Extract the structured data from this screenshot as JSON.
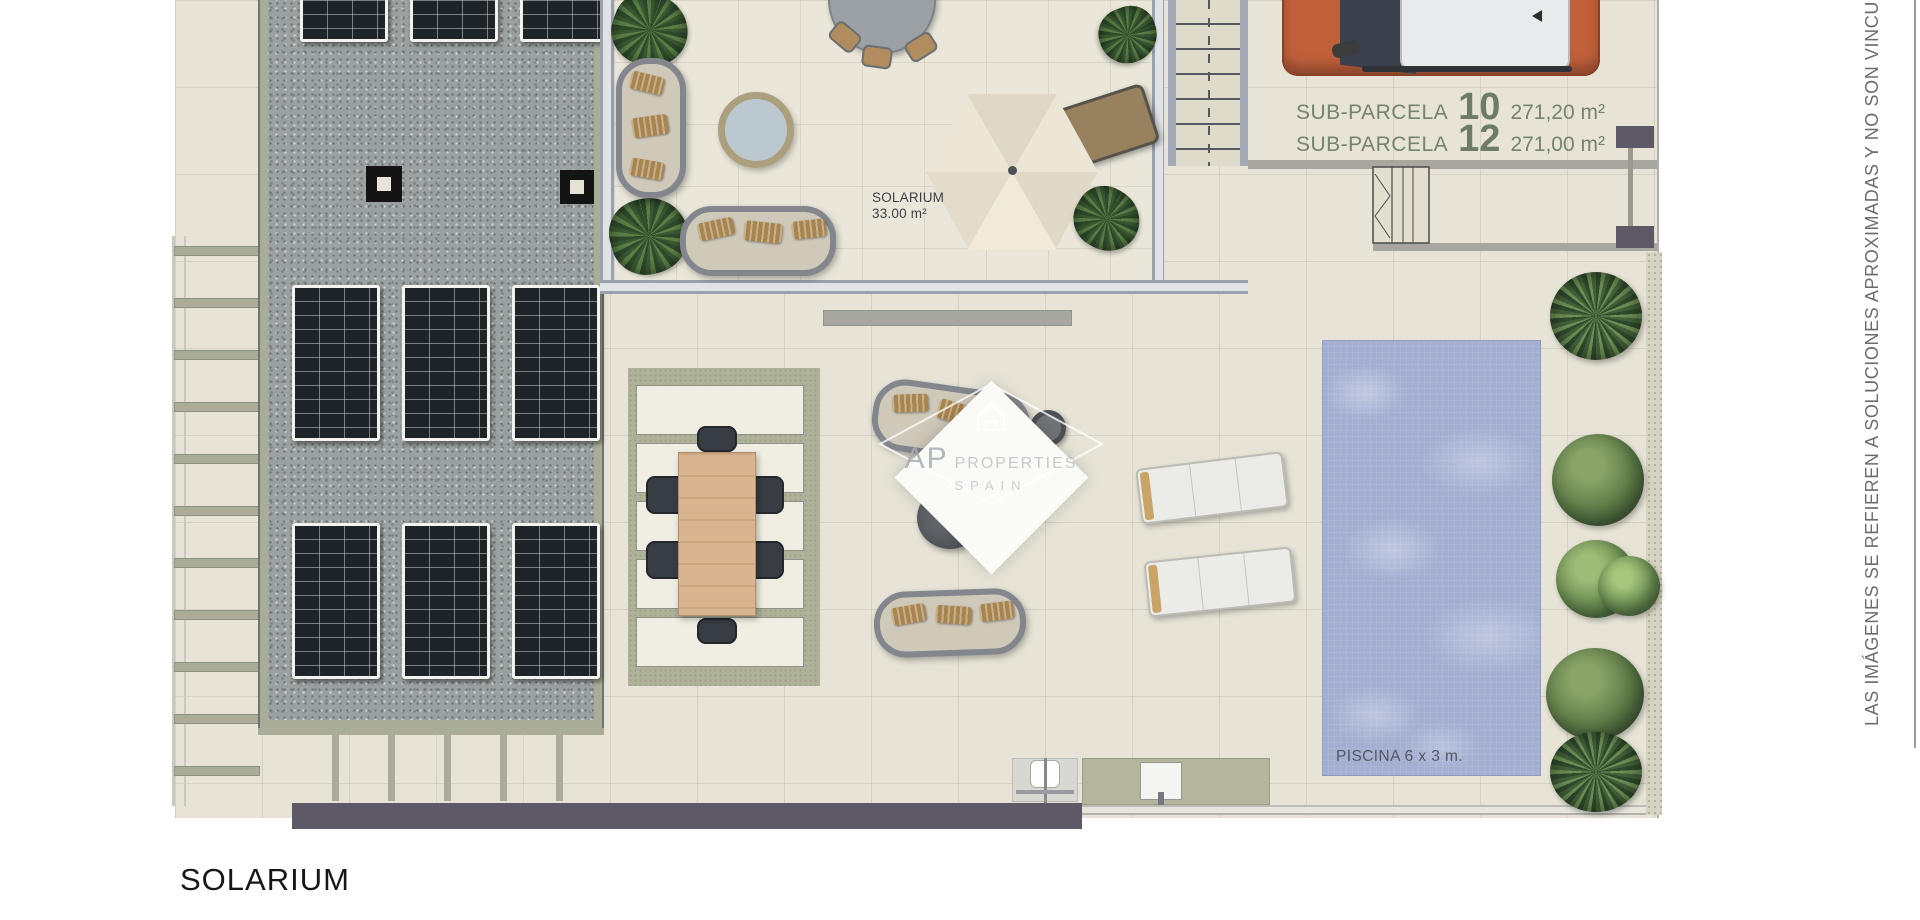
{
  "plan": {
    "title": "SOLARIUM",
    "disclaimer": "LAS IMÁGENES SE REFIEREN A SOLUCIONES APROXIMADAS Y NO SON VINCU",
    "watermark": {
      "brand_initials": "AP",
      "brand_name": "PROPERTIES",
      "brand_region": "SPAIN"
    },
    "labels": {
      "sub_parcelas": [
        {
          "name": "SUB-PARCELA",
          "number": "10",
          "area": "271,20 m²"
        },
        {
          "name": "SUB-PARCELA",
          "number": "12",
          "area": "271,00 m²"
        }
      ],
      "solarium_zone": {
        "name": "SOLARIUM",
        "area": "33.00 m²"
      },
      "pool": "PISCINA 6 x 3 m."
    },
    "colors": {
      "pool_water": "#a3aed1",
      "label_green": "#75836f",
      "terrace_tile": "#e7e4d7",
      "gravel_roof": "#9ba1a0",
      "dark_wall": "#5e5967",
      "car_orange": "#c0603b",
      "vegetation": "#5d7b47"
    },
    "icons": [
      "solar-panel",
      "roof-vent",
      "parasol",
      "sun-lounger",
      "pool",
      "palm-tree",
      "round-tree",
      "stairs",
      "car",
      "outdoor-shower",
      "watermark-house"
    ]
  }
}
